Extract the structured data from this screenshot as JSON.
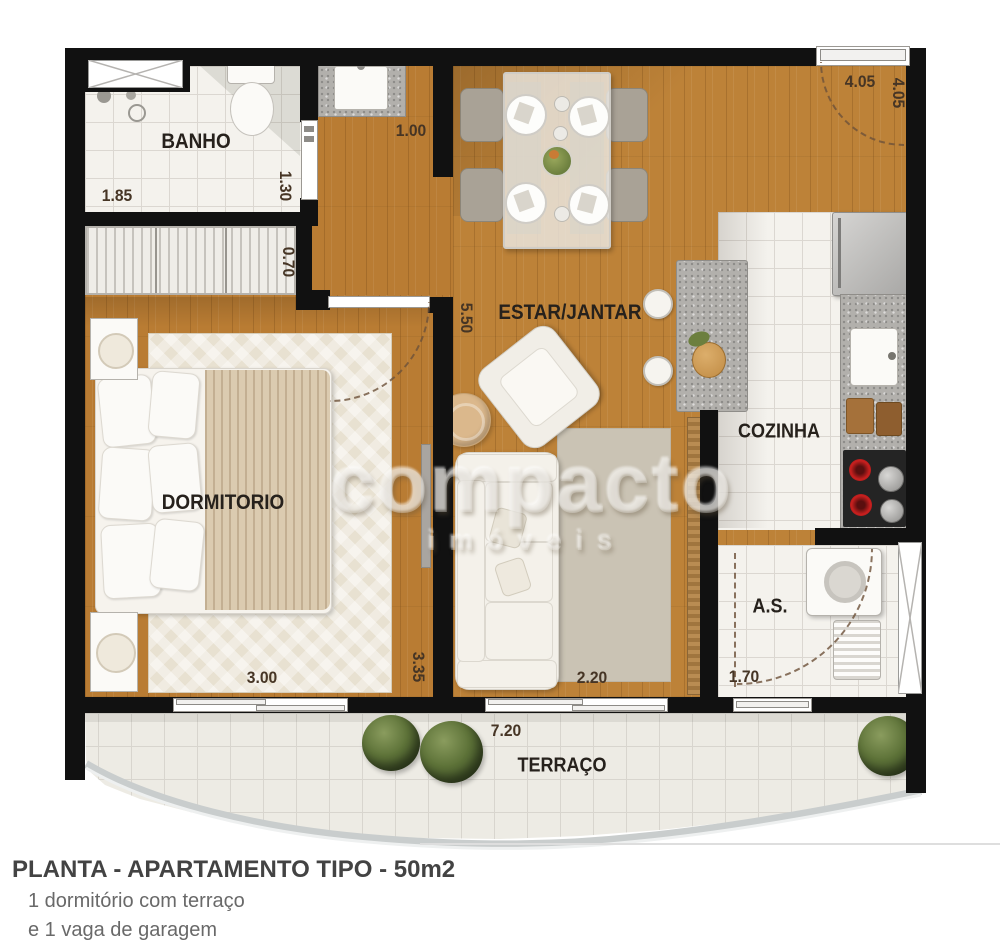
{
  "plan": {
    "rooms": {
      "banho": "BANHO",
      "estar": "ESTAR/JANTAR",
      "dormitorio": "DORMITORIO",
      "cozinha": "COZINHA",
      "servico": "A.S.",
      "terraco": "TERRAÇO"
    },
    "dims": {
      "banho_width": "1.85",
      "banho_depth": "1.30",
      "closet_depth": "0.70",
      "hall_width": "1.00",
      "entry_width": "4.05",
      "entry_depth": "4.05",
      "living_depth": "5.50",
      "bedroom_width": "3.00",
      "bedroom_depth": "3.35",
      "living_width": "2.20",
      "service_width": "1.70",
      "terrace_width": "7.20"
    },
    "watermark": {
      "brand": "compacto",
      "sub": "imóveis"
    },
    "colors": {
      "wall": "#111111",
      "wood": "#b97c33",
      "tile": "#f4f2ed",
      "granite": "#b2b0ac"
    }
  },
  "caption": {
    "title": "PLANTA - APARTAMENTO TIPO - 50m2",
    "line1": "1 dormitório com terraço",
    "line2": "e 1 vaga de garagem"
  }
}
